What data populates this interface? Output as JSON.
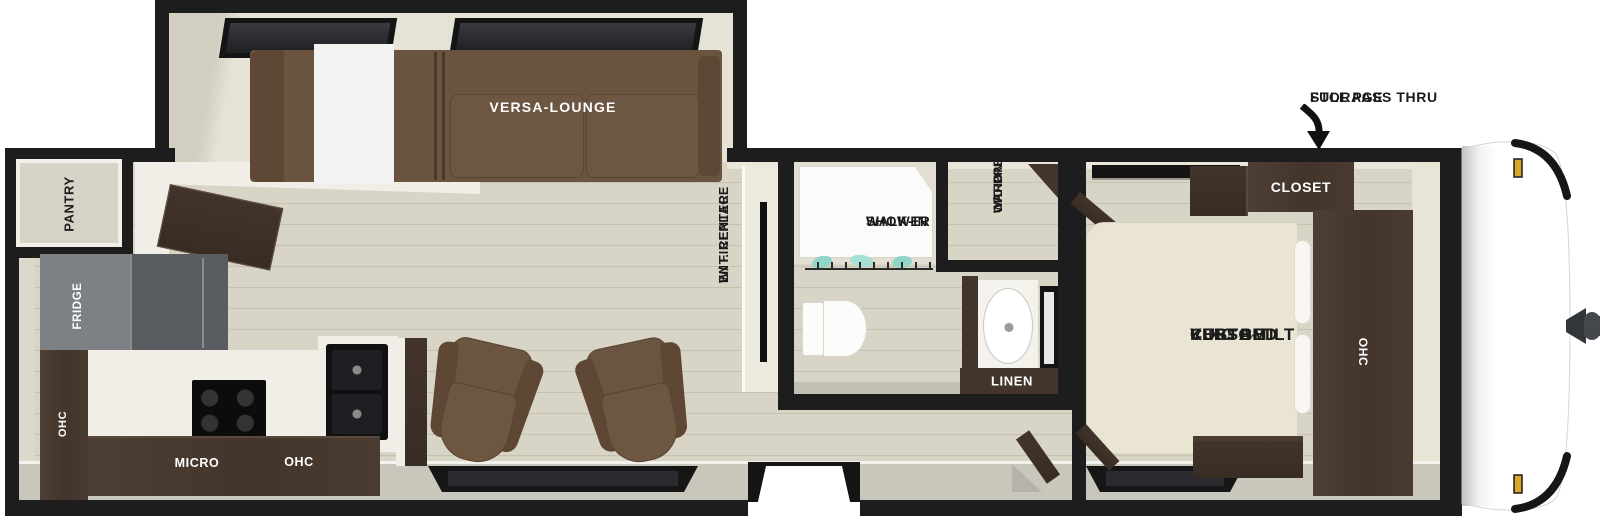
{
  "title": "Travel trailer floor plan",
  "colors": {
    "wall": "#1d1d1d",
    "floor": "#d9d5c6",
    "plank_line": "#c6c2b2",
    "cabinet_wood": "#46382e",
    "sofa_brown": "#6a5440",
    "chair_brown": "#6b5440",
    "bed_cream": "#e9e5d2",
    "fridge_gray": "#7d8084",
    "shower_glass_teal": "#8fd6c9",
    "marker_light_gold": "#d8a62c",
    "interior_band_gray": "#c9c6bc",
    "fixture_white": "#fafaf8"
  },
  "labels": {
    "pantry": "PANTRY",
    "fridge": "FRIDGE",
    "kitchen_ohc_left": "OHC",
    "kitchen_micro": "MICRO",
    "kitchen_ohc": "OHC",
    "versa_lounge": "VERSA-LOUNGE",
    "ent_center": [
      "ENT. CENTER",
      "W/ FIREPLACE"
    ],
    "shower": [
      "WALK-IN",
      "SHOWER"
    ],
    "ward": [
      "WARD",
      "W/D PREP",
      "OPTION"
    ],
    "linen": "LINEN",
    "king_bed": [
      "VERSA-TILT",
      "CUSTOM",
      "KING BED"
    ],
    "closet": "CLOSET",
    "bedroom_ohc": "OHC",
    "pass_thru": [
      "FULL PASS THRU",
      "STORAGE"
    ]
  }
}
